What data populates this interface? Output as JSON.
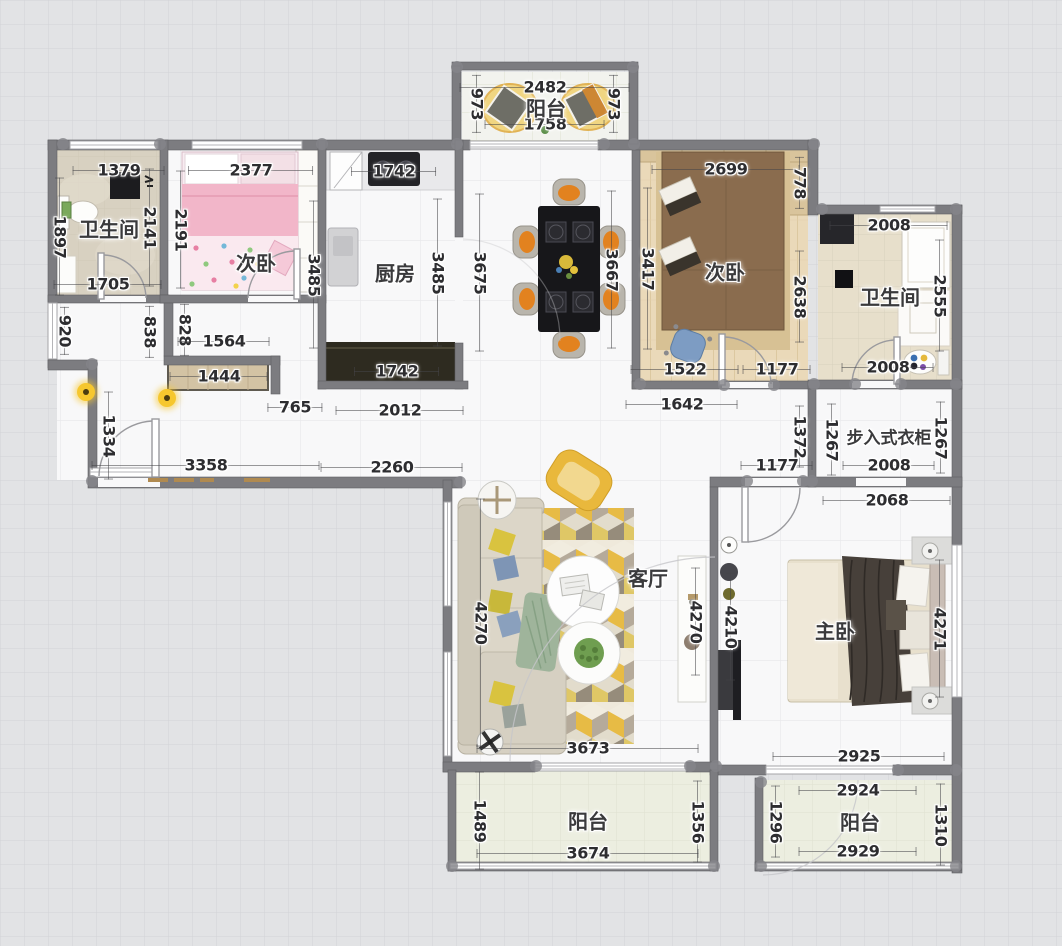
{
  "canvas": {
    "type": "floor-plan",
    "background": "#e2e3e5",
    "wall_color": "#7c7c80",
    "accent_yellow": "#e7bb45",
    "wood_floor": "#ead9b9",
    "dimension_unit": "mm"
  },
  "rooms": [
    {
      "label": "阳台",
      "x": 546,
      "y": 107,
      "size": 20
    },
    {
      "label": "卫生间",
      "x": 109,
      "y": 228,
      "size": 20
    },
    {
      "label": "次卧",
      "x": 256,
      "y": 262,
      "size": 20
    },
    {
      "label": "厨房",
      "x": 395,
      "y": 272,
      "size": 20
    },
    {
      "label": "次卧",
      "x": 725,
      "y": 271,
      "size": 20
    },
    {
      "label": "卫生间",
      "x": 890,
      "y": 296,
      "size": 20
    },
    {
      "label": "步入式衣柜",
      "x": 889,
      "y": 436,
      "size": 17
    },
    {
      "label": "客厅",
      "x": 648,
      "y": 577,
      "size": 20
    },
    {
      "label": "主卧",
      "x": 835,
      "y": 630,
      "size": 20
    },
    {
      "label": "阳台",
      "x": 588,
      "y": 820,
      "size": 20
    },
    {
      "label": "阳台",
      "x": 860,
      "y": 821,
      "size": 20
    }
  ],
  "dimensions": [
    {
      "v": "2482",
      "x": 545,
      "y": 87,
      "o": "h",
      "l": 170
    },
    {
      "v": "1758",
      "x": 545,
      "y": 124,
      "o": "h",
      "l": 120
    },
    {
      "v": "973",
      "x": 477,
      "y": 104,
      "o": "v",
      "l": 58
    },
    {
      "v": "973",
      "x": 614,
      "y": 104,
      "o": "v",
      "l": 58
    },
    {
      "v": "1379",
      "x": 119,
      "y": 170,
      "o": "h",
      "l": 92
    },
    {
      "v": "1897",
      "x": 60,
      "y": 237,
      "o": "v",
      "l": 118
    },
    {
      "v": "2141",
      "x": 150,
      "y": 228,
      "o": "v",
      "l": 118
    },
    {
      "v": "1705",
      "x": 108,
      "y": 284,
      "o": "h",
      "l": 108
    },
    {
      "v": "2377",
      "x": 251,
      "y": 170,
      "o": "h",
      "l": 125
    },
    {
      "v": "2191",
      "x": 181,
      "y": 230,
      "o": "v",
      "l": 118
    },
    {
      "v": "3485",
      "x": 314,
      "y": 275,
      "o": "v",
      "l": 148
    },
    {
      "v": "1742",
      "x": 394,
      "y": 171,
      "o": "h",
      "l": 85
    },
    {
      "v": "3485",
      "x": 438,
      "y": 273,
      "o": "v",
      "l": 148
    },
    {
      "v": "3675",
      "x": 480,
      "y": 273,
      "o": "v",
      "l": 158
    },
    {
      "v": "1742",
      "x": 397,
      "y": 371,
      "o": "h",
      "l": 85
    },
    {
      "v": "3667",
      "x": 612,
      "y": 270,
      "o": "v",
      "l": 158
    },
    {
      "v": "3417",
      "x": 648,
      "y": 269,
      "o": "v",
      "l": 162
    },
    {
      "v": "2699",
      "x": 726,
      "y": 169,
      "o": "h",
      "l": 148
    },
    {
      "v": "778",
      "x": 800,
      "y": 183,
      "o": "v",
      "l": 52
    },
    {
      "v": "2638",
      "x": 800,
      "y": 297,
      "o": "v",
      "l": 92
    },
    {
      "v": "1522",
      "x": 685,
      "y": 369,
      "o": "h",
      "l": 108
    },
    {
      "v": "1177",
      "x": 777,
      "y": 369,
      "o": "h",
      "l": 68
    },
    {
      "v": "2008",
      "x": 889,
      "y": 225,
      "o": "h",
      "l": 118
    },
    {
      "v": "2555",
      "x": 940,
      "y": 296,
      "o": "v",
      "l": 112
    },
    {
      "v": "2008",
      "x": 888,
      "y": 367,
      "o": "h",
      "l": 92
    },
    {
      "v": "920",
      "x": 65,
      "y": 331,
      "o": "v",
      "l": 48
    },
    {
      "v": "838",
      "x": 150,
      "y": 332,
      "o": "v",
      "l": 52
    },
    {
      "v": "828",
      "x": 185,
      "y": 330,
      "o": "v",
      "l": 52
    },
    {
      "v": "1564",
      "x": 224,
      "y": 341,
      "o": "h",
      "l": 92
    },
    {
      "v": "1444",
      "x": 219,
      "y": 376,
      "o": "h",
      "l": 98
    },
    {
      "v": "765",
      "x": 295,
      "y": 407,
      "o": "h",
      "l": 55
    },
    {
      "v": "2012",
      "x": 400,
      "y": 410,
      "o": "h",
      "l": 128
    },
    {
      "v": "1334",
      "x": 109,
      "y": 436,
      "o": "v",
      "l": 88
    },
    {
      "v": "3358",
      "x": 206,
      "y": 465,
      "o": "h",
      "l": 228
    },
    {
      "v": "2260",
      "x": 392,
      "y": 467,
      "o": "h",
      "l": 142
    },
    {
      "v": "1642",
      "x": 682,
      "y": 404,
      "o": "h",
      "l": 112
    },
    {
      "v": "1372",
      "x": 800,
      "y": 437,
      "o": "v",
      "l": 62
    },
    {
      "v": "1177",
      "x": 777,
      "y": 465,
      "o": "h",
      "l": 72
    },
    {
      "v": "1267",
      "x": 832,
      "y": 440,
      "o": "v",
      "l": 72
    },
    {
      "v": "1267",
      "x": 941,
      "y": 438,
      "o": "v",
      "l": 72
    },
    {
      "v": "2008",
      "x": 889,
      "y": 465,
      "o": "h",
      "l": 92
    },
    {
      "v": "2068",
      "x": 887,
      "y": 500,
      "o": "h",
      "l": 128
    },
    {
      "v": "4270",
      "x": 481,
      "y": 623,
      "o": "v",
      "l": 248
    },
    {
      "v": "4270",
      "x": 696,
      "y": 622,
      "o": "v",
      "l": 108
    },
    {
      "v": "4210",
      "x": 731,
      "y": 627,
      "o": "v",
      "l": 108
    },
    {
      "v": "4271",
      "x": 940,
      "y": 629,
      "o": "v",
      "l": 138
    },
    {
      "v": "3673",
      "x": 588,
      "y": 748,
      "o": "h",
      "l": 222
    },
    {
      "v": "2925",
      "x": 859,
      "y": 756,
      "o": "h",
      "l": 172
    },
    {
      "v": "1489",
      "x": 480,
      "y": 821,
      "o": "v",
      "l": 98
    },
    {
      "v": "3674",
      "x": 588,
      "y": 853,
      "o": "h",
      "l": 222
    },
    {
      "v": "1356",
      "x": 698,
      "y": 822,
      "o": "v",
      "l": 82
    },
    {
      "v": "2924",
      "x": 858,
      "y": 790,
      "o": "h",
      "l": 118
    },
    {
      "v": "1296",
      "x": 776,
      "y": 822,
      "o": "v",
      "l": 72
    },
    {
      "v": "2929",
      "x": 858,
      "y": 851,
      "o": "h",
      "l": 118
    },
    {
      "v": "1310",
      "x": 941,
      "y": 825,
      "o": "v",
      "l": 82
    }
  ],
  "ceiling_lights": [
    {
      "x": 86,
      "y": 392
    },
    {
      "x": 167,
      "y": 398
    }
  ]
}
